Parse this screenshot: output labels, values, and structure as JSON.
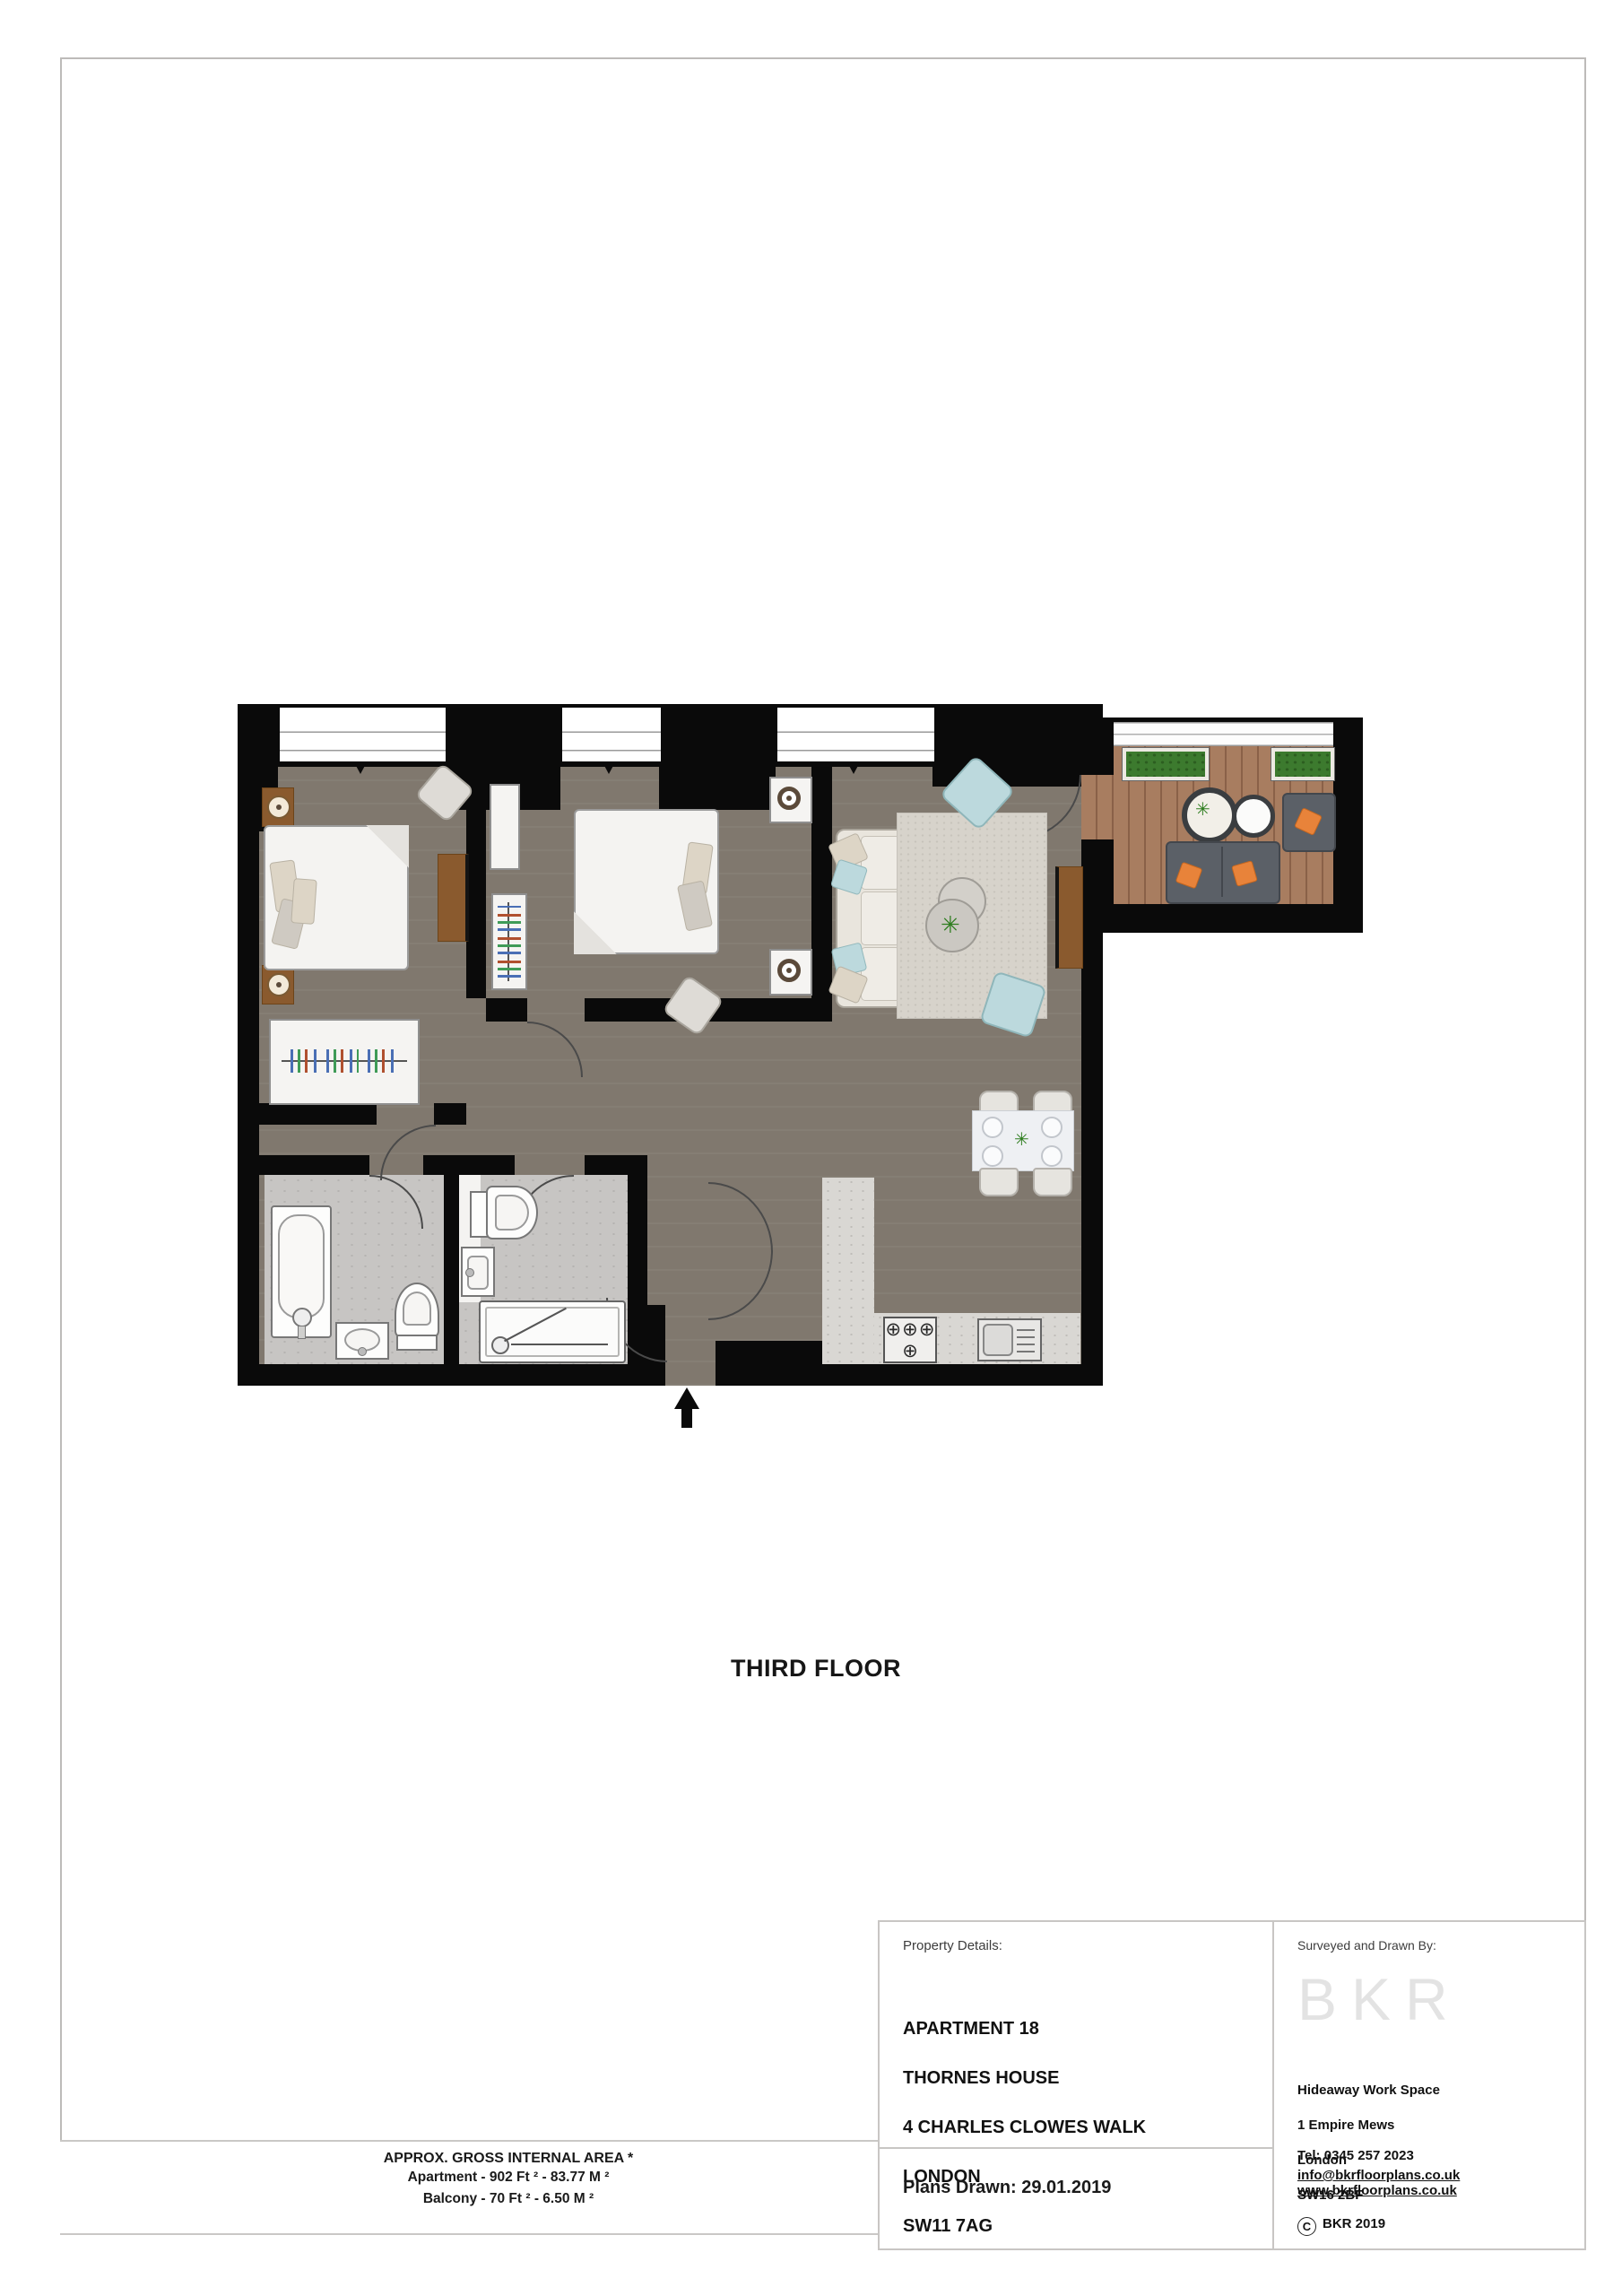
{
  "floor_plan": {
    "floor_label": "THIRD FLOOR"
  },
  "area_summary": {
    "title": "APPROX. GROSS INTERNAL AREA *",
    "apartment_line": "Apartment - 902 Ft ²  -  83.77 M ²",
    "balcony_line": "Balcony - 70 Ft ²  -  6.50 M ²"
  },
  "title_block": {
    "property_details_label": "Property Details:",
    "address_lines": [
      "APARTMENT 18",
      "THORNES HOUSE",
      "4 CHARLES CLOWES WALK",
      "LONDON",
      "SW11 7AG"
    ],
    "plans_drawn": "Plans Drawn: 29.01.2019"
  },
  "surveyor_block": {
    "label": "Surveyed and Drawn By:",
    "logo_text": "BKR",
    "address_lines": [
      "Hideaway Work Space",
      "1 Empire Mews",
      "London",
      "SW16 2BF"
    ],
    "tel": "Tel:  0345 257 2023",
    "email": "info@bkrfloorplans.co.uk",
    "website": "www.bkrfloorplans.co.uk",
    "copyright_symbol": "C",
    "copyright_text": "BKR 2019"
  },
  "colors": {
    "wall": "#0a0a0a",
    "floor_dark": "#80786e",
    "tile_light": "#c7c5c3",
    "kitchen_counter": "#d9d7d3",
    "rug": "#d7d3cb",
    "balcony_deck": "#a87d60",
    "accent_orange": "#e8833a",
    "pouf_blue": "#bcd9dd",
    "furniture_brown": "#8a5a2e",
    "planter_green": "#3c7a2e"
  }
}
